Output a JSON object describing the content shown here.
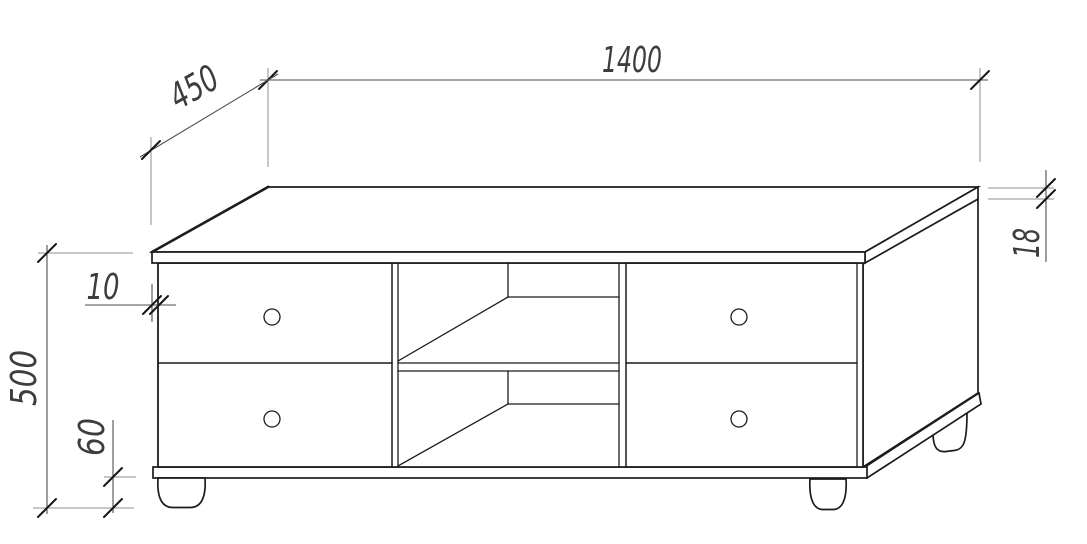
{
  "drawing": {
    "dimensions": {
      "width": "1400",
      "depth": "450",
      "height": "500",
      "leg_height": "60",
      "top_overhang": "10",
      "top_thickness": "18"
    },
    "structure": {
      "drawer_count": 4,
      "knob_count": 4,
      "open_compartments": 2,
      "visible_legs": 3
    },
    "colors": {
      "background": "#ffffff",
      "object_line": "#1c1c1c",
      "dimension_line": "#4f4f4f",
      "extension_line": "#8e8e8e",
      "text": "#3d3d3d"
    }
  }
}
